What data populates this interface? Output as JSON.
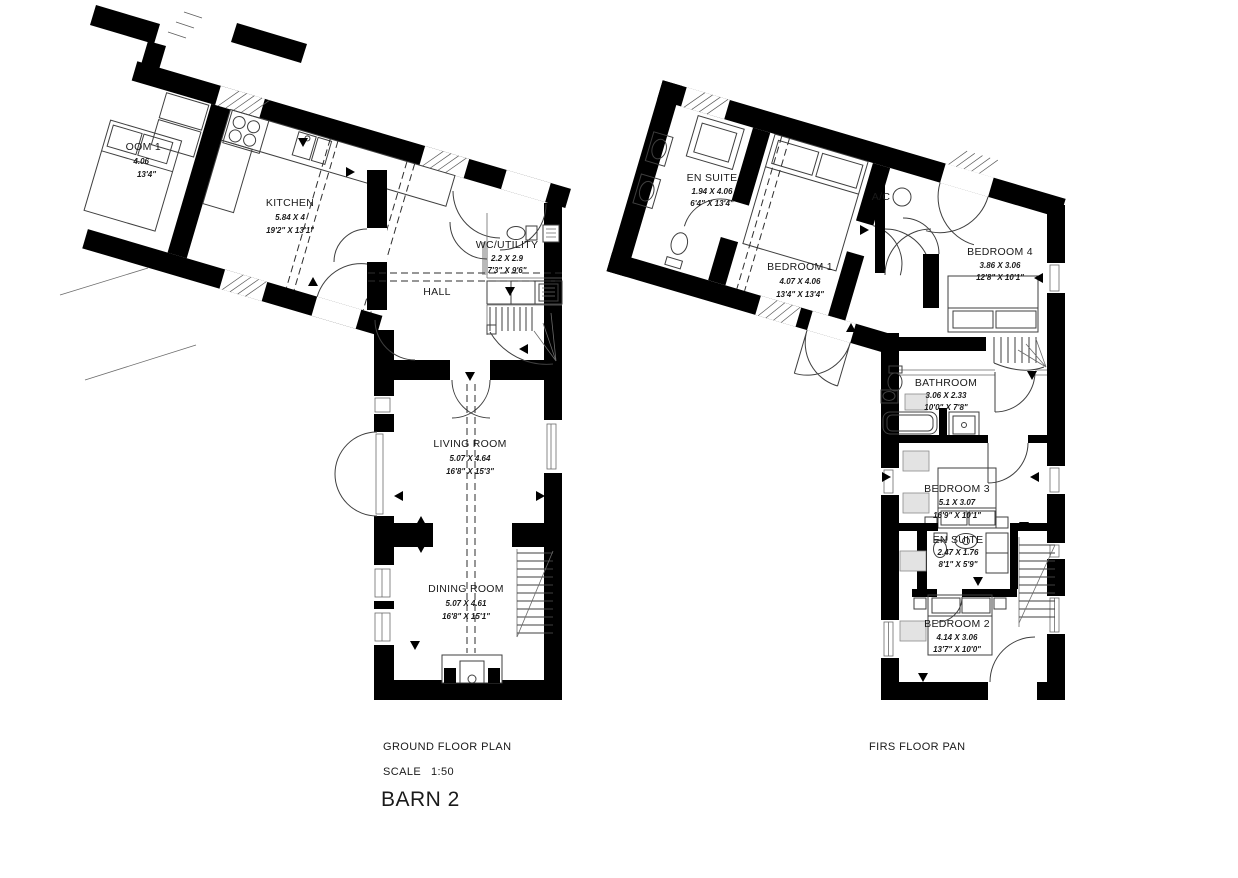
{
  "title_block": {
    "ground_floor_label": "GROUND FLOOR PLAN",
    "scale_label": "SCALE",
    "scale_value": "1:50",
    "drawing_title": "BARN 2",
    "first_floor_label": "FIRS FLOOR PAN"
  },
  "ground_floor": {
    "rooms": {
      "adjacent_partial": {
        "name": "OOM 1",
        "metric": "4.06",
        "imperial": "13'4\""
      },
      "kitchen": {
        "name": "KITCHEN",
        "metric": "5.84 X 4",
        "imperial": "19'2\" X 13'1\""
      },
      "wc_utility": {
        "name": "WC/UTILITY",
        "metric": "2.2 X 2.9",
        "imperial": "7'3\" X 9'6\""
      },
      "hall": {
        "name": "HALL"
      },
      "living_room": {
        "name": "LIVING ROOM",
        "metric": "5.07 X 4.64",
        "imperial": "16'8\" X 15'3\""
      },
      "dining_room": {
        "name": "DINING ROOM",
        "metric": "5.07 X 4.61",
        "imperial": "16'8\" X 15'1\""
      }
    }
  },
  "first_floor": {
    "rooms": {
      "en_suite_1": {
        "name": "EN SUITE",
        "metric": "1.94 X 4.06",
        "imperial": "6'4\" X 13'4\""
      },
      "bedroom_1": {
        "name": "BEDROOM 1",
        "metric": "4.07 X 4.06",
        "imperial": "13'4\" X 13'4\""
      },
      "ac_cupboard": {
        "name": "A/C"
      },
      "bedroom_4": {
        "name": "BEDROOM 4",
        "metric": "3.86 X 3.06",
        "imperial": "12'8\" X 10'1\""
      },
      "bathroom": {
        "name": "BATHROOM",
        "metric": "3.06 X 2.33",
        "imperial": "10'0\" X 7'8\""
      },
      "bedroom_3": {
        "name": "BEDROOM 3",
        "metric": "5.1 X 3.07",
        "imperial": "16'9\" X 10'1\""
      },
      "en_suite_2": {
        "name": "EN SUITE",
        "metric": "2.47 X 1.76",
        "imperial": "8'1\" X 5'9\""
      },
      "bedroom_2": {
        "name": "BEDROOM 2",
        "metric": "4.14 X 3.06",
        "imperial": "13'7\" X 10'0\""
      }
    }
  },
  "colors": {
    "wall": "#000000",
    "linework": "#3f3f3f",
    "skylight": "#e3e3e3",
    "text": "#1a1a1a",
    "background": "#ffffff"
  }
}
